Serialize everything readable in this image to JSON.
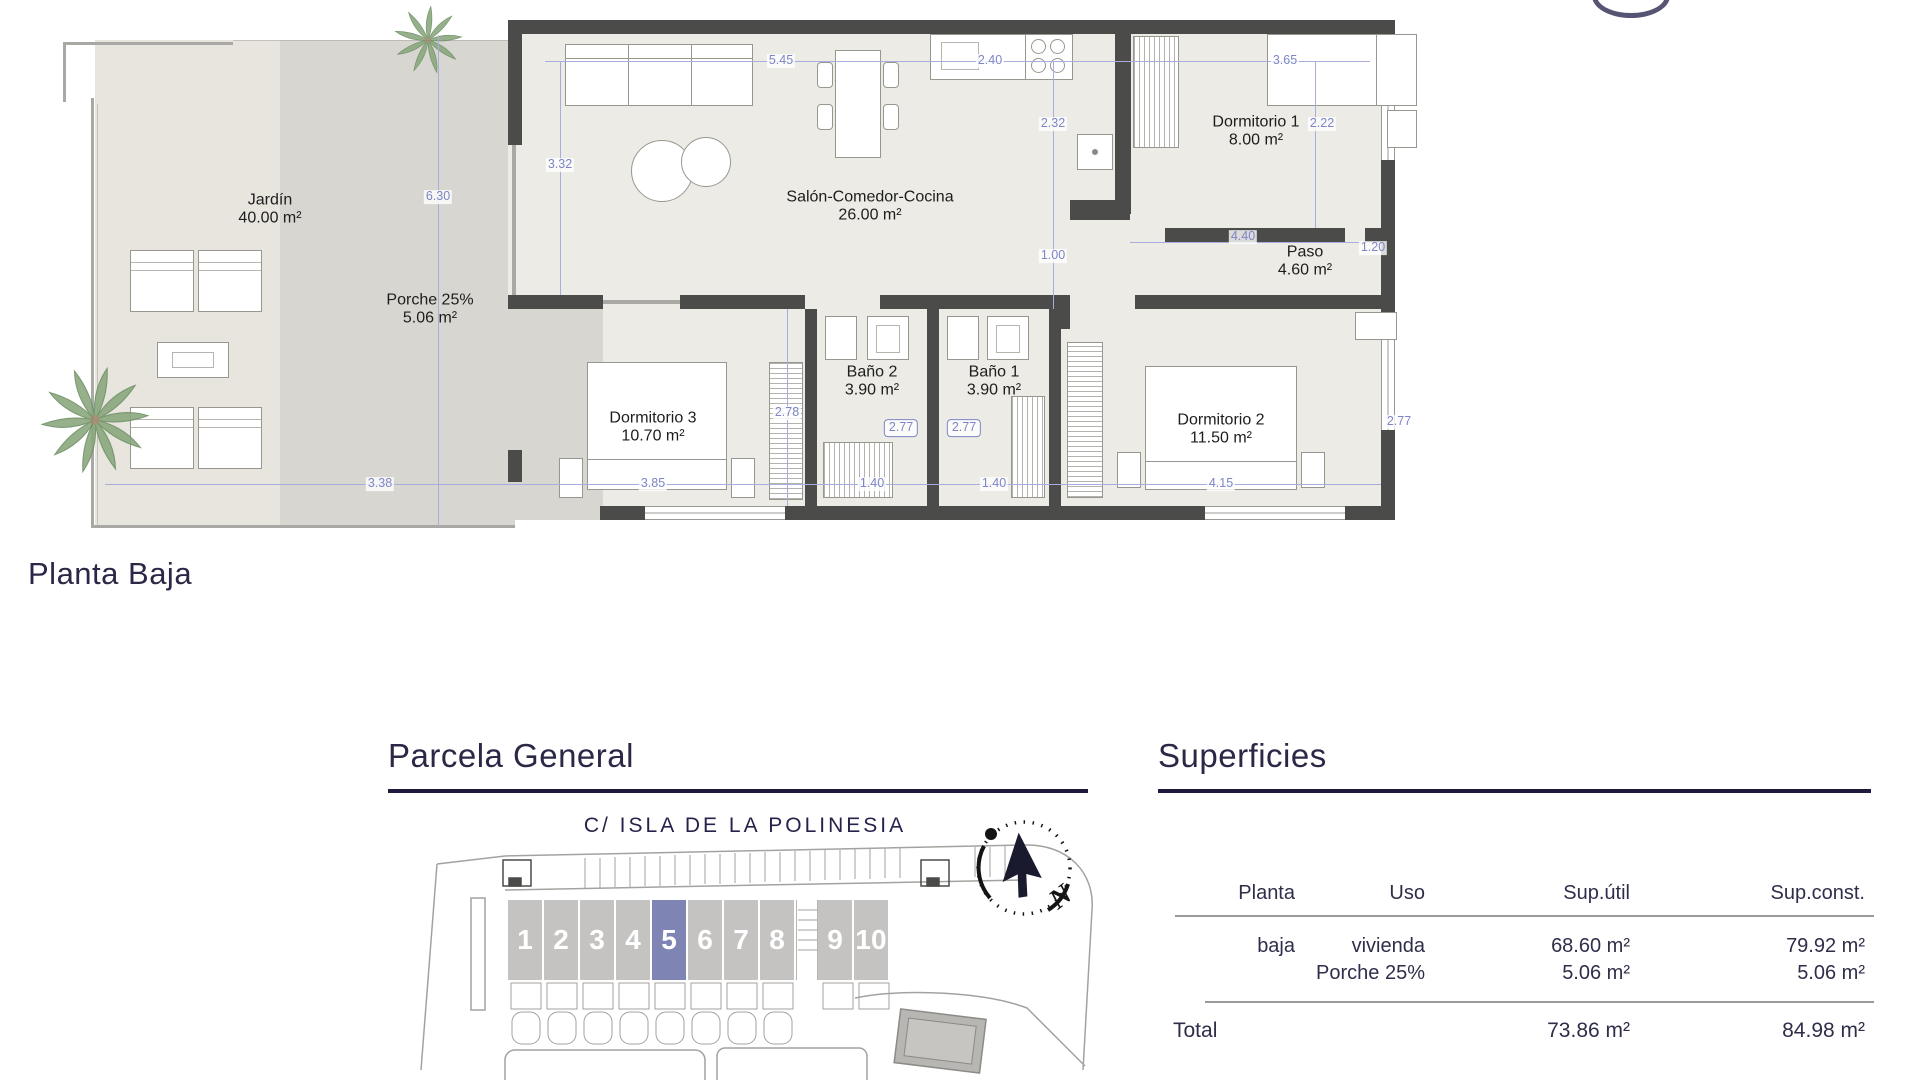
{
  "floor_plan": {
    "title": "Planta Baja",
    "rooms": {
      "jardin": {
        "name": "Jardín",
        "area": "40.00 m²"
      },
      "porche": {
        "name": "Porche 25%",
        "area": "5.06 m²"
      },
      "salon": {
        "name": "Salón-Comedor-Cocina",
        "area": "26.00 m²"
      },
      "dormitorio1": {
        "name": "Dormitorio 1",
        "area": "8.00 m²"
      },
      "paso": {
        "name": "Paso",
        "area": "4.60 m²"
      },
      "dormitorio2": {
        "name": "Dormitorio 2",
        "area": "11.50 m²"
      },
      "dormitorio3": {
        "name": "Dormitorio 3",
        "area": "10.70 m²"
      },
      "bano1": {
        "name": "Baño 1",
        "area": "3.90 m²"
      },
      "bano2": {
        "name": "Baño 2",
        "area": "3.90 m²"
      }
    },
    "dimensions": {
      "salon_width": "5.45",
      "kitchen_width": "2.40",
      "dorm1_width": "3.65",
      "salon_depth": "3.32",
      "kitchen_depth": "2.32",
      "dorm1_depth": "2.22",
      "garden_depth": "6.30",
      "pass_gap": "1.00",
      "paso_width": "4.40",
      "paso_end": "1.20",
      "dorm3_depth": "2.78",
      "bano2_depth": "2.77",
      "bano1_depth": "2.77",
      "dorm2_depth": "2.77",
      "garden_width": "3.38",
      "dorm3_width": "3.85",
      "bano2_width": "1.40",
      "bano1_width": "1.40",
      "dorm2_width": "4.15"
    }
  },
  "parcela": {
    "heading": "Parcela General",
    "street": "C/ ISLA DE LA POLINESIA",
    "units": [
      "1",
      "2",
      "3",
      "4",
      "5",
      "6",
      "7",
      "8",
      "9",
      "10"
    ],
    "highlighted_unit": "5",
    "compass_north": "N"
  },
  "superficies": {
    "heading": "Superficies",
    "columns": [
      "Planta",
      "Uso",
      "Sup.útil",
      "Sup.const."
    ],
    "rows": [
      {
        "planta": "baja",
        "uso": "vivienda",
        "sup_util": "68.60 m²",
        "sup_const": "79.92 m²"
      },
      {
        "planta": "",
        "uso": "Porche 25%",
        "sup_util": "5.06 m²",
        "sup_const": "5.06 m²"
      }
    ],
    "total": {
      "label": "Total",
      "sup_util": "73.86 m²",
      "sup_const": "84.98 m²"
    }
  },
  "colors": {
    "heading": "#2b2847",
    "dimension": "#7d85c6",
    "wall": "#4b4b49",
    "unit": "#c4c3c2",
    "unit_highlight": "#7e84b4"
  }
}
